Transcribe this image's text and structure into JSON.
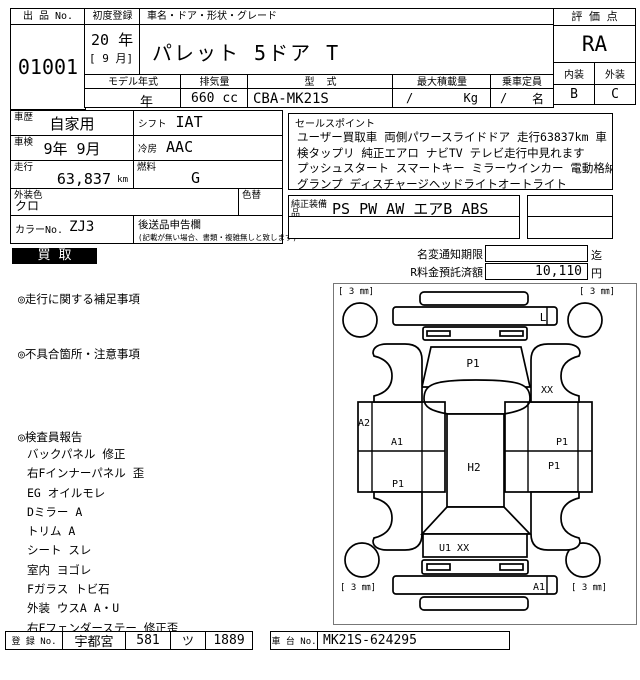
{
  "header": {
    "lot_label": "出 品 No.",
    "lot_no": "01001",
    "first_reg_label": "初度登録",
    "first_reg_year": "20 年",
    "first_reg_month": "[ 9 月]",
    "name_label": "車名・ドア・形状・グレード",
    "car_name": "パレット 5ドア T",
    "model_year_label": "モデル年式",
    "model_year_value": "年",
    "displacement_label": "排気量",
    "displacement_value": "660 cc",
    "model_code_label": "型  式",
    "model_code_value": "CBA-MK21S",
    "max_load_label": "最大積載量",
    "max_load_value": "/",
    "max_load_unit": "Kg",
    "capacity_label": "乗車定員",
    "capacity_value": "/",
    "capacity_unit": "名",
    "score_label": "評 価 点",
    "score": "RA",
    "interior_label": "内装",
    "interior_score": "B",
    "exterior_label": "外装",
    "exterior_score": "C"
  },
  "info": {
    "history_label": "車歴",
    "history": "自家用",
    "shift_label": "シフト",
    "shift": "IAT",
    "inspection_label": "車検",
    "inspection": "9年 9月",
    "ac_label": "冷房",
    "ac": "AAC",
    "mileage_label": "走行",
    "mileage": "63,837",
    "mileage_unit": "km",
    "fuel_label": "燃料",
    "fuel": "G",
    "ext_color_label": "外装色",
    "ext_color": "クロ",
    "color_change_label": "色替",
    "color_no_label": "カラーNo.",
    "color_no": "ZJ3",
    "later_items_label": "後送品申告欄",
    "later_items_note": "(記載が無い場合、書類・複雑無しと致します)"
  },
  "sales": {
    "title": "セールスポイント",
    "lines": [
      "ユーザー買取車 両側パワースライドドア 走行63837km 車",
      "検タップリ 純正エアロ ナビTV テレビ走行中見れます",
      "プッシュスタート スマートキー ミラーウインカー 電動格納ドアミラー フォ",
      "グランプ ディスチャージヘッドライトオートライト"
    ],
    "equipment_label": "純正装備品",
    "equipment": "PS PW AW エアB ABS"
  },
  "status": {
    "kaitori": "買取",
    "name_change_label": "名変通知期限",
    "name_change_value": "",
    "name_change_suffix": "迄",
    "recycle_label": "R料金預託済額",
    "recycle_value": "10,110",
    "recycle_unit": "円"
  },
  "notes": {
    "driving_label": "◎走行に関する補足事項",
    "defects_label": "◎不具合箇所・注意事項",
    "inspector_label": "◎検査員報告",
    "inspector_items": [
      "バックパネル 修正",
      "右Fインナーパネル 歪",
      "EG オイルモレ",
      "Dミラー A",
      "トリム A",
      "シート スレ",
      "室内 ヨゴレ",
      "Fガラス トビ石",
      "外装 ウスA A・U",
      "右Fフェンダーステー 修正歪"
    ]
  },
  "diagram": {
    "tire_label": "[ 3 ㎜]",
    "labels": {
      "front_bumper": "L",
      "hood": "P1",
      "right_mirror": "XX",
      "left_sill": "A2",
      "left_front_door": "A1",
      "left_rear_panel": "P1",
      "roof": "H2",
      "right_front_panel": "P1",
      "right_rear_panel": "P1",
      "rear_gate": "U1  XX",
      "rear_bumper": "A1"
    }
  },
  "footer": {
    "reg_label": "登 録 No.",
    "reg_area": "宇都宮",
    "reg_class": "581",
    "reg_kana": "ツ",
    "reg_number": "1889",
    "chassis_label": "車 台 No.",
    "chassis_no": "MK21S-624295"
  }
}
